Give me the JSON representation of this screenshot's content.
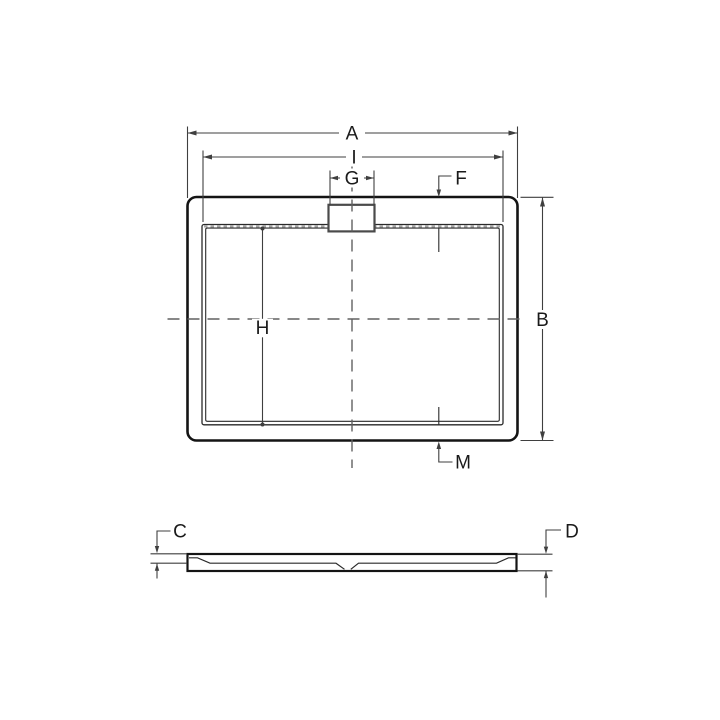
{
  "plan_view": {
    "dim_a": "A",
    "dim_i": "I",
    "dim_g": "G",
    "dim_f": "F",
    "dim_b": "B",
    "dim_h": "H",
    "dim_m": "M"
  },
  "side_view": {
    "dim_c": "C",
    "dim_d": "D"
  },
  "colors": {
    "background": "#ffffff",
    "outline": "#141414",
    "thin_line": "#2a2a2a",
    "dim_line": "#3f3f3f",
    "centerline": "#616161",
    "seal_dashes": "#a6a6a6",
    "drain_outline": "#4a4a4a",
    "label_text": "#1a1a1a"
  }
}
